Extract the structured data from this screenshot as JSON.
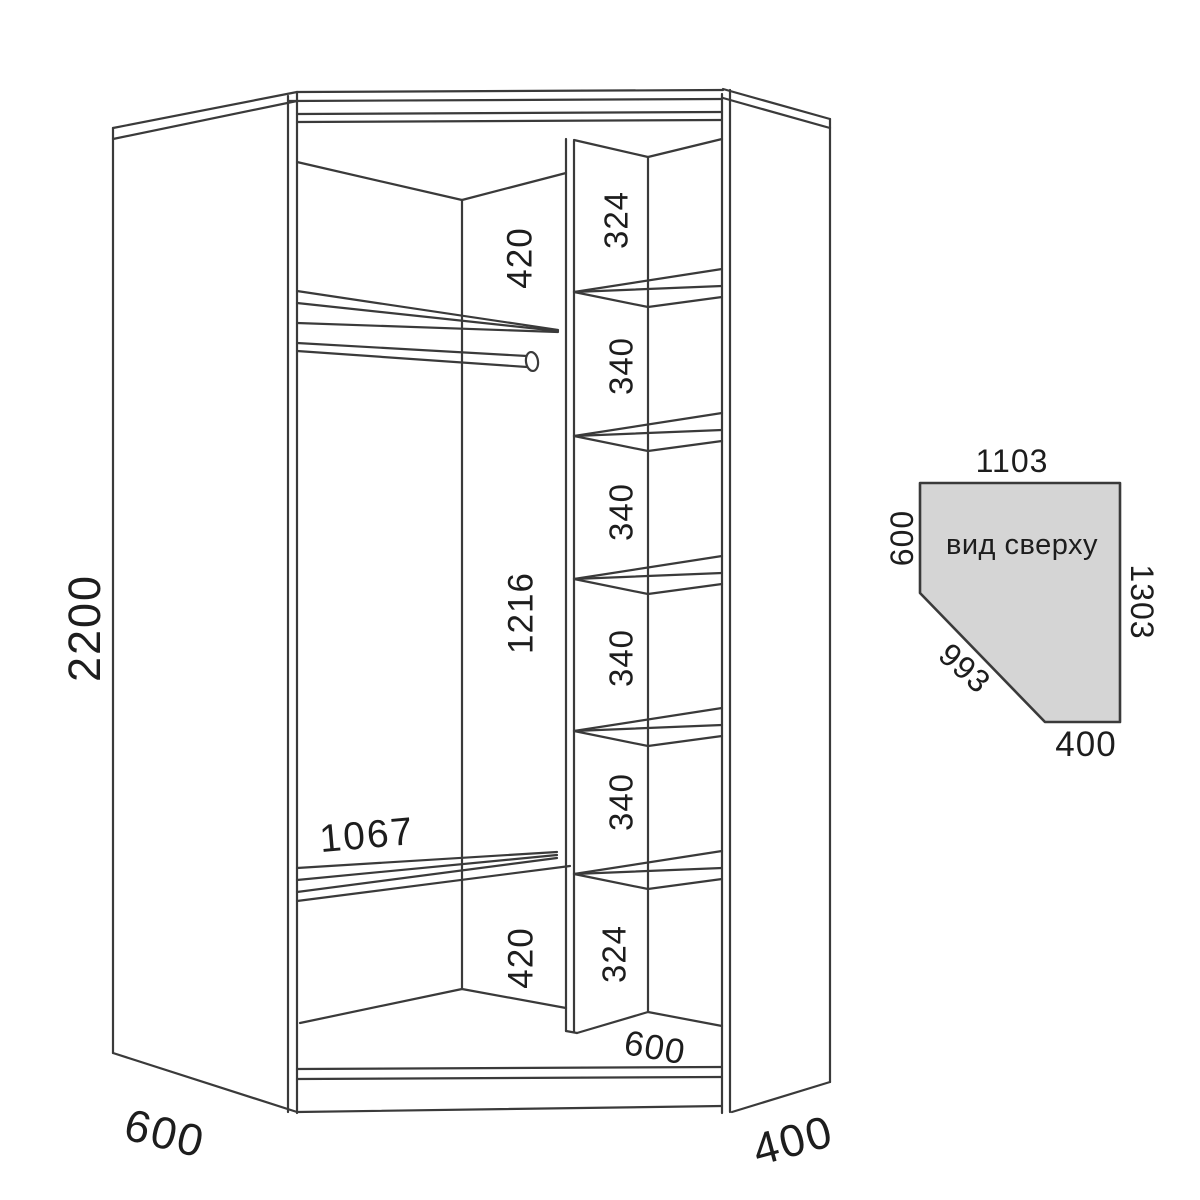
{
  "front_view": {
    "height": "2200",
    "depth_left": "600",
    "depth_right": "400",
    "sections": {
      "top_420": "420",
      "middle_1216": "1216",
      "shelf_1067": "1067",
      "bottom_420": "420"
    },
    "column": {
      "comp_1": "324",
      "comp_2": "340",
      "comp_3": "340",
      "comp_4": "340",
      "com_placeholder": "",
      "comp_5": "340",
      "comp_6": "324",
      "width": "600"
    }
  },
  "top_view": {
    "label": "вид сверху",
    "top": "1103",
    "left": "600",
    "right": "1303",
    "diagonal": "993",
    "bottom": "400"
  },
  "colors": {
    "line": "#3a3a3a",
    "text": "#1d1d1d",
    "top_view_fill": "#d5d5d5",
    "background": "#ffffff"
  }
}
